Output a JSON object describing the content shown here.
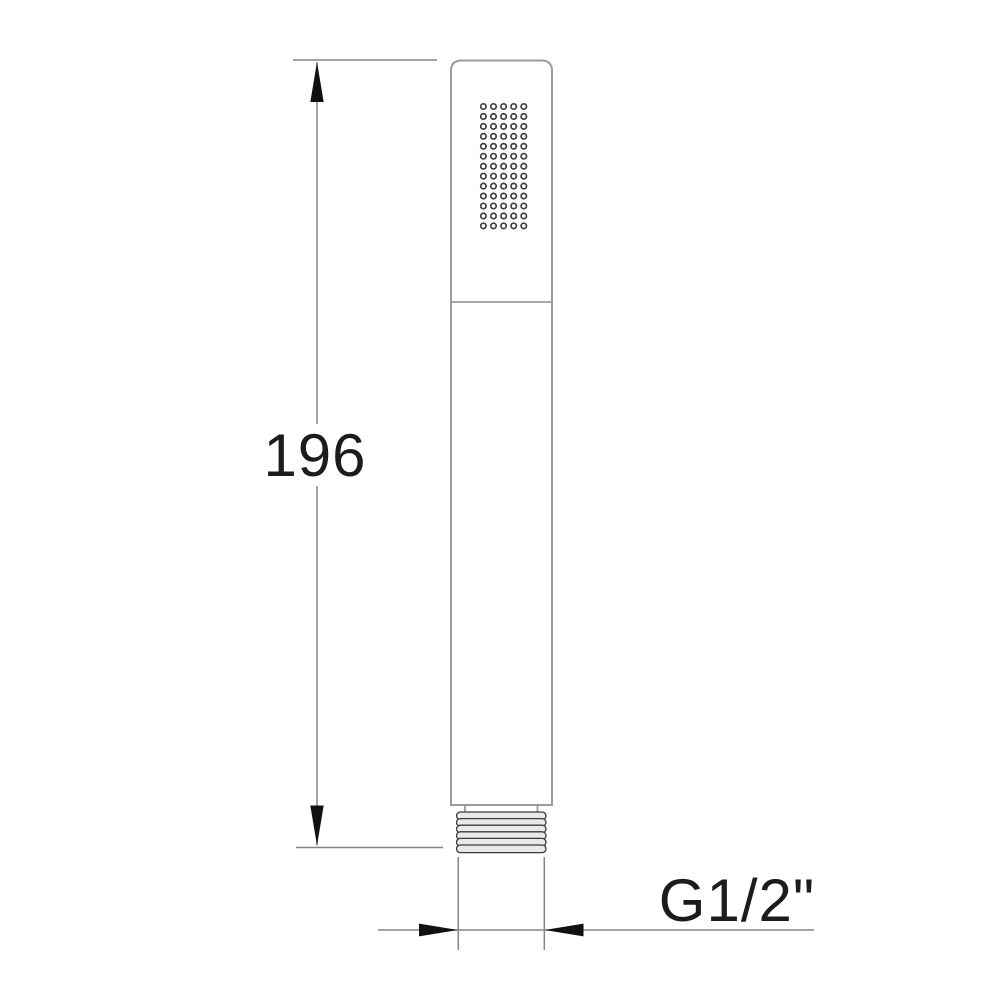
{
  "dimensions": {
    "length_label": "196",
    "thread_label": "G1/2\""
  },
  "spray_grid": {
    "rows": 13,
    "cols": 5
  },
  "colors": {
    "outline": "#9b9b9b",
    "dimension_line": "#858585",
    "arrow": "#111111",
    "text": "#1c1c1c",
    "dot_ring": "#3f3f3f",
    "thread_fill": "#e9e9e9",
    "thread_stroke": "#3a3a3a",
    "bg": "#ffffff"
  }
}
